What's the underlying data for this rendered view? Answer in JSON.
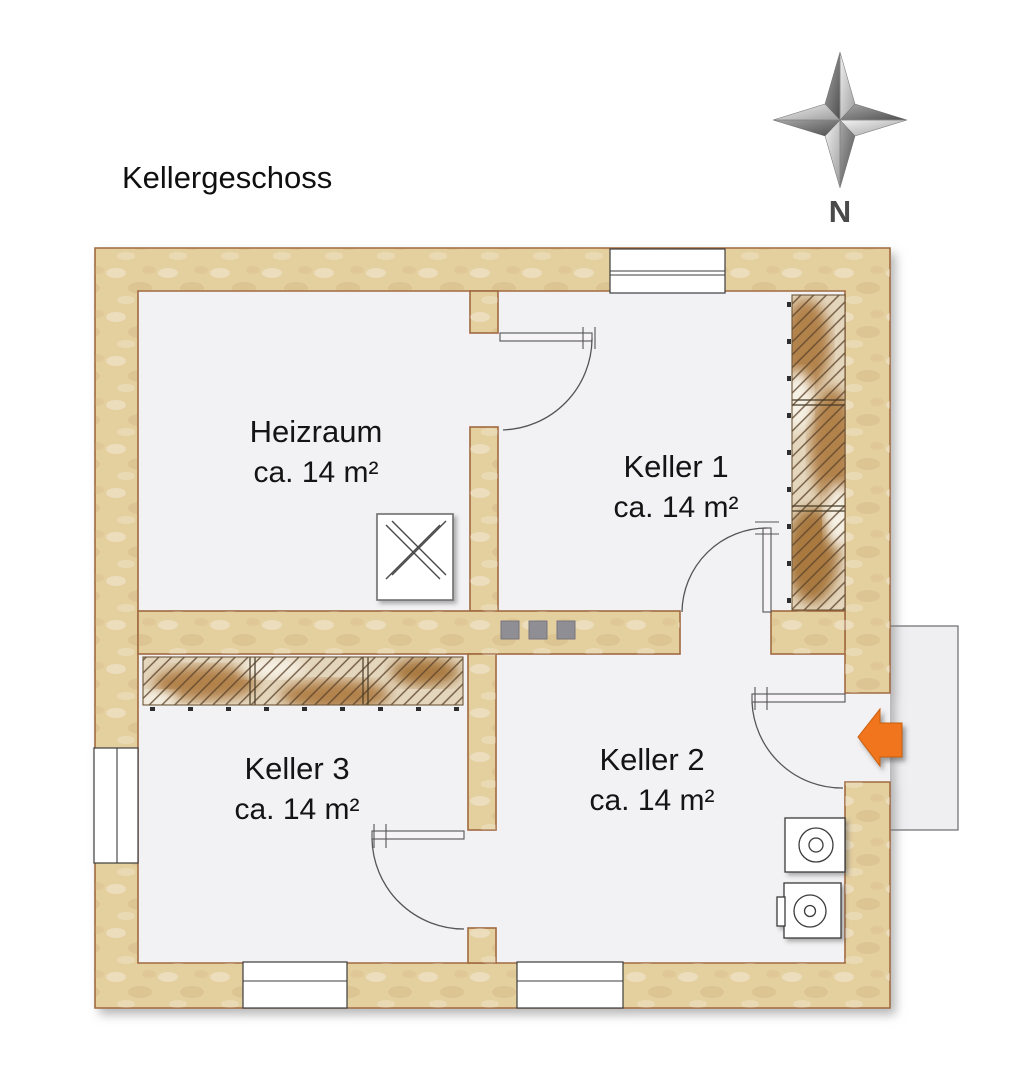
{
  "title": "Kellergeschoss",
  "compass": {
    "label": "N"
  },
  "rooms": [
    {
      "id": "heizraum",
      "name": "Heizraum",
      "area": "ca. 14 m²"
    },
    {
      "id": "keller1",
      "name": "Keller 1",
      "area": "ca. 14 m²"
    },
    {
      "id": "keller2",
      "name": "Keller 2",
      "area": "ca. 14 m²"
    },
    {
      "id": "keller3",
      "name": "Keller 3",
      "area": "ca. 14 m²"
    }
  ],
  "colors": {
    "wall": "#e4cf9f",
    "wall_outline": "#a06a40",
    "floor": "#f2f1f3",
    "accent": "#f0751c"
  }
}
